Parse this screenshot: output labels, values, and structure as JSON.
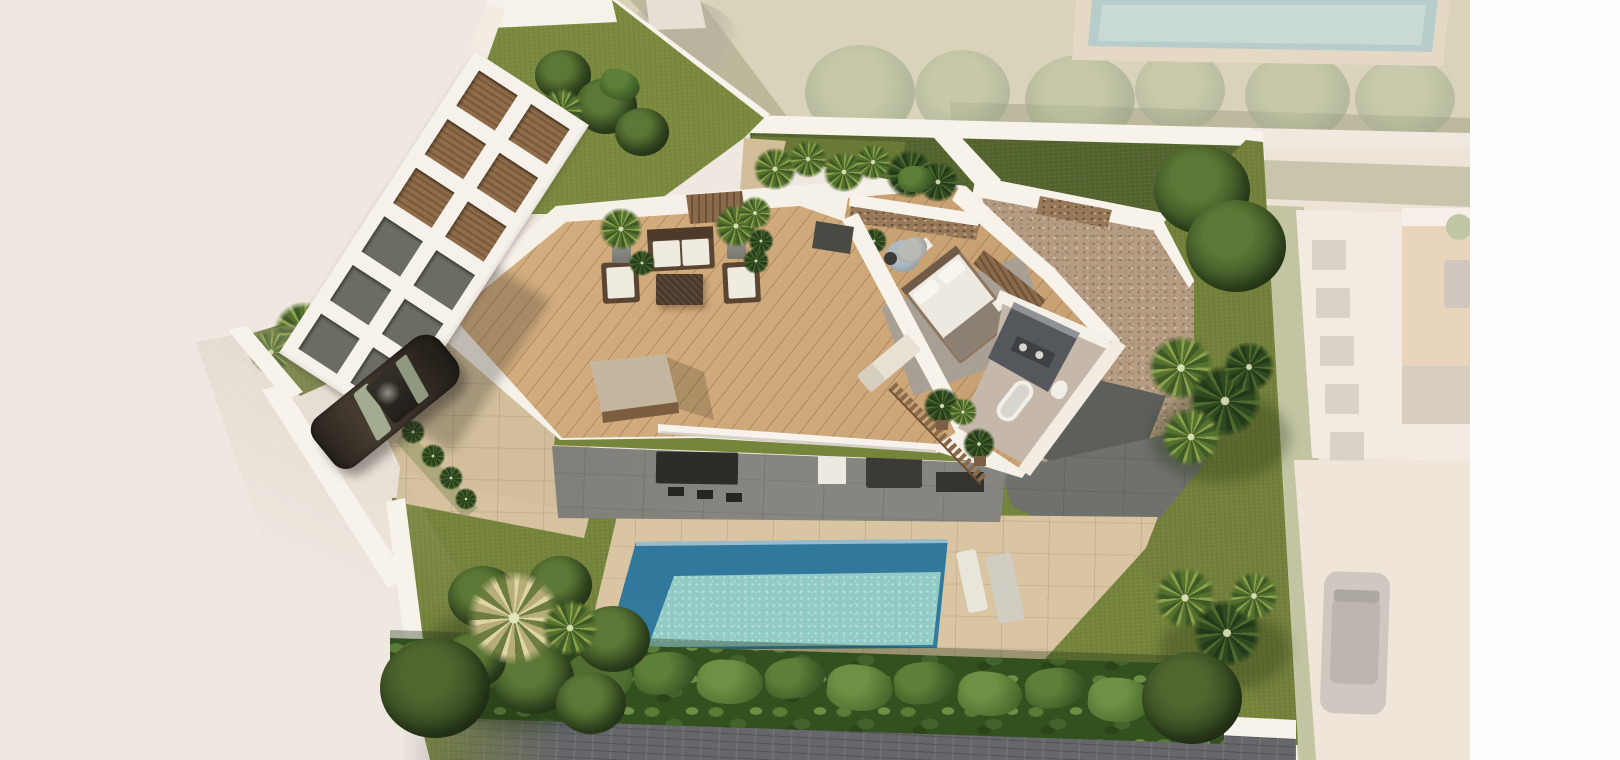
{
  "image_type": "3d-architectural-render",
  "scene": {
    "description": "Aerial isometric photorealistic render of a modern single-storey villa plot. Centre: elongated roof-terrace deck with outdoor lounge furniture, cutaway master bedroom and bathroom under stone feature walls, pebble-gravel flat roof to the right. Left: white pergola carport grid over a driveway with a parked dark car. Bottom: olive lawn garden with rectangular swimming pool, beige paver terrace, sun loungers, banana-plant hedge along the street wall and palm clusters. Neighbouring plots (top and right, incl. a second pool and villa with parked car) are washed out / faded; plain white margin at far right; pale beige empty ground at lower left.",
    "view": "top-down aerial, scene tilted slightly anticlockwise",
    "visible_text": [],
    "areas": [
      "background-ground",
      "neighbor-plot-top",
      "neighbor-pool",
      "boundary-walls",
      "front-lawn-triangle",
      "back-lawn-strip",
      "roof-terrace-deck",
      "pergola-carport",
      "driveway",
      "master-bedroom-cutaway",
      "bathroom-cutaway",
      "gravel-flat-roof",
      "covered-patio",
      "garden-lawn",
      "pool-terrace",
      "swimming-pool",
      "banana-hedge",
      "street",
      "cobble-sidewalk",
      "right-lawn",
      "neighbor-villa-faded",
      "white-margin"
    ],
    "objects": [
      "outdoor-sofa",
      "armchair-left",
      "armchair-right",
      "wicker-coffee-table",
      "potted-plants",
      "agave-plants",
      "beige-awning",
      "glass-balustrade",
      "double-bed",
      "bedside-tables",
      "bedroom-armchair",
      "wardrobe-slats",
      "stone-gabion-wall",
      "walk-in-shower",
      "vanity-with-sinks",
      "bathtub",
      "toilet",
      "picket-fence-planters",
      "deck-sun-lounger",
      "pool-loungers",
      "dining-table-with-stools",
      "patio-sofa",
      "dark-car",
      "faded-neighbor-car",
      "palm-trees",
      "banana-trees",
      "leafy-trees"
    ],
    "counts": {
      "pergola_openings": 12,
      "hedge_shrubs": 13,
      "faded_building_windows": 5
    }
  },
  "palette": {
    "background": "#EFE8E0",
    "white_margin": "#FFFEFD",
    "walls_white": "#F7F2EA",
    "lawn_bright": "#7C8A3F",
    "lawn_olive": "#76853C",
    "lawn_dark_strip": "#55652F",
    "neighbor_ground_khaki": "#D8D3B9",
    "deck_wood": "#D3AD7E",
    "interior_wood": "#C9A273",
    "gravel": "#B49B82",
    "gravel_dark_patch": "#5D5F5B",
    "pool_deep": "#2A7090",
    "pool_shallow": "#92CBC5",
    "neighbor_pool_faded": "#B7CDCB",
    "terrace_pavers": "#D9C5A2",
    "patio_grey": "#86857F",
    "street_cobbles": "#65676B",
    "sidewalk": "#C6B9A6",
    "hedge_green": "#33501F",
    "palm_bright": "#8BA14B",
    "palm_dark": "#2F4A20",
    "palm_cream": "#DDD3A4",
    "stone_gabion": "#96785A",
    "wood_slats": "#8A6A4A",
    "furniture_frame": "#5A4532",
    "cushion_white": "#EFEBE1",
    "awning": "#C9BBA4",
    "car_body": "#352D25",
    "car_glass": "#A3AC90",
    "faded_building": "#F3EBE1",
    "faded_lawn": "#B7BB95"
  }
}
